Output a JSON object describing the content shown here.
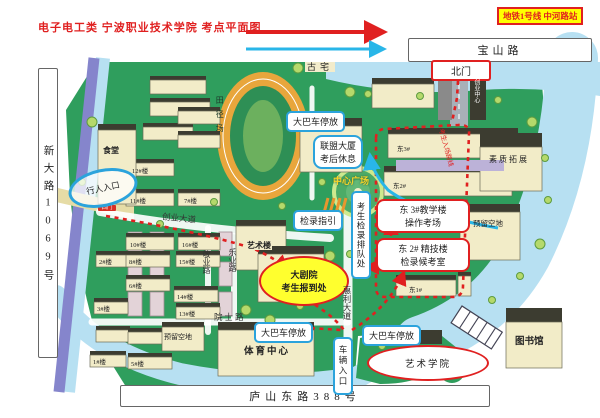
{
  "colors": {
    "accent_red": "#e02020",
    "callout_blue": "#2ba3dc",
    "route_cyan": "#29b6e8",
    "metro_yellow": "#ffff00",
    "campus_green": "#2f9e5d",
    "water_blue": "#b7e0f2",
    "road_purple": "#8585cc",
    "building_cream": "#f2ecc8",
    "track_orange": "#e8a63c"
  },
  "header": {
    "title": "电子电工类 宁波职业技术学院 考点平面图",
    "metro_badge": "地铁1号线 中河路站"
  },
  "frame_roads": {
    "top": "宝山路",
    "left_vertical": "新大路1069号",
    "bottom": "庐山东路388号"
  },
  "gates": {
    "north": "北门",
    "west": "西门",
    "pedestrian_entrance": "行人入口",
    "vehicle_entrance": "车辆入口"
  },
  "callouts": {
    "bus_parking_top": "大巴车停放",
    "bus_parking_southwest": "大巴车停放",
    "bus_parking_southeast": "大巴车停放",
    "union_tower_rest_line1": "联盟大厦",
    "union_tower_rest_line2": "考后休息",
    "check_in_guide": "检录指引",
    "candidate_queue": "考生检录排队处",
    "east3_line1": "东 3#教学楼",
    "east3_line2": "操作考场",
    "east2_line1": "东 2# 精技楼",
    "east2_line2": "检录候考室",
    "theater_line1": "大剧院",
    "theater_line2": "考生报到处",
    "art_college": "艺术学院",
    "entry_route_note": "考生入场路线"
  },
  "places": {
    "canteen": "食堂",
    "track": "田径场",
    "central_plaza": "中心广场",
    "ancient_house": "古宅",
    "art_building": "艺术楼",
    "sports_center": "体育中心",
    "library": "图书馆",
    "quality_development": "素质拓展",
    "reserved_land_east": "预留空地",
    "reserved_land_west": "预留空地",
    "innovation_center": "创业中心"
  },
  "inner_roads": {
    "chuangye_avenue": "创业大道",
    "jingye_road": "敬业路",
    "leye_road": "乐业路",
    "yuanshi_road": "院士路",
    "huili_avenue": "惠利大道"
  },
  "buildings": [
    "12#楼",
    "11#楼",
    "7#楼",
    "10#楼",
    "16#楼",
    "2#楼",
    "8#楼",
    "15#楼",
    "6#楼",
    "14#楼",
    "3#楼",
    "13#楼",
    "1#楼",
    "5#楼",
    "东3#",
    "东2#",
    "东1#"
  ]
}
